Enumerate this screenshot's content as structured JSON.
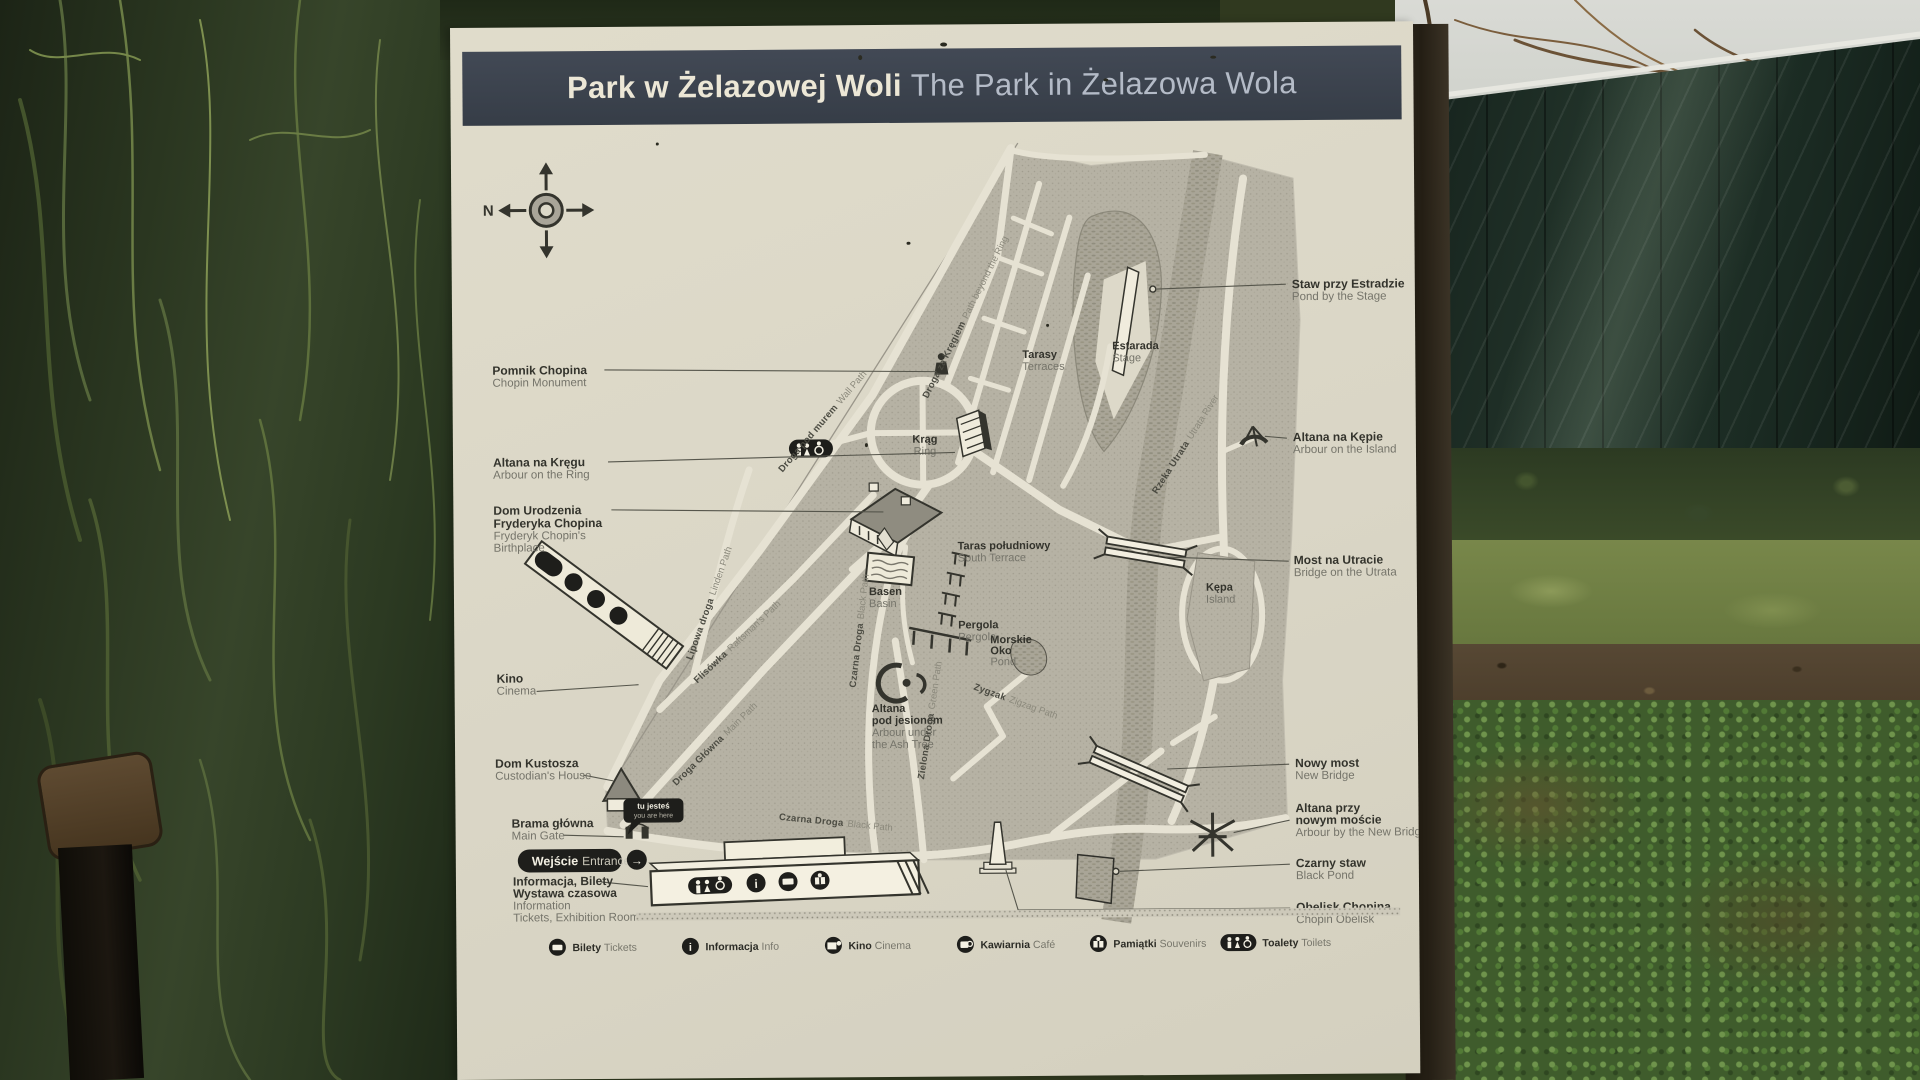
{
  "sign": {
    "title": {
      "pl": "Park w Żelazowej Woli",
      "en": "The Park in Żelazowa Wola"
    },
    "compass": {
      "north": "N"
    },
    "entrance": {
      "pl": "Wejście",
      "en": "Entrance",
      "arrow": "→"
    },
    "you_are_here": {
      "pl": "tu jesteś",
      "en": "you are here"
    },
    "glyphs": {
      "info": "i"
    },
    "callouts_left": [
      {
        "pl": [
          "Pomnik Chopina"
        ],
        "en": [
          "Chopin Monument"
        ]
      },
      {
        "pl": [
          "Altana na Kręgu"
        ],
        "en": [
          "Arbour on the Ring"
        ]
      },
      {
        "pl": [
          "Dom Urodzenia",
          "Fryderyka Chopina"
        ],
        "en": [
          "Fryderyk Chopin's",
          "Birthplace"
        ]
      },
      {
        "pl": [
          "Kino"
        ],
        "en": [
          "Cinema"
        ]
      },
      {
        "pl": [
          "Dom Kustosza"
        ],
        "en": [
          "Custodian's House"
        ]
      },
      {
        "pl": [
          "Brama główna"
        ],
        "en": [
          "Main Gate"
        ]
      },
      {
        "pl": [
          "Informacja, Bilety",
          "Wystawa czasowa"
        ],
        "en": [
          "Information",
          "Tickets, Exhibition Room"
        ]
      }
    ],
    "callouts_right": [
      {
        "pl": [
          "Staw przy Estradzie"
        ],
        "en": [
          "Pond by the Stage"
        ]
      },
      {
        "pl": [
          "Altana na Kępie"
        ],
        "en": [
          "Arbour on the Island"
        ]
      },
      {
        "pl": [
          "Most na Utracie"
        ],
        "en": [
          "Bridge on the Utrata"
        ]
      },
      {
        "pl": [
          "Nowy most"
        ],
        "en": [
          "New Bridge"
        ]
      },
      {
        "pl": [
          "Altana przy",
          "nowym moście"
        ],
        "en": [
          "Arbour by the New Bridge"
        ]
      },
      {
        "pl": [
          "Czarny staw"
        ],
        "en": [
          "Black Pond"
        ]
      },
      {
        "pl": [
          "Obelisk Chopina"
        ],
        "en": [
          "Chopin Obelisk"
        ]
      }
    ],
    "map_labels": [
      {
        "pl": [
          "Estarada"
        ],
        "en": [
          "Stage"
        ]
      },
      {
        "pl": [
          "Tarasy"
        ],
        "en": [
          "Terraces"
        ]
      },
      {
        "pl": [
          "Krąg"
        ],
        "en": [
          "Ring"
        ]
      },
      {
        "pl": [
          "Taras południowy"
        ],
        "en": [
          "South Terrace"
        ]
      },
      {
        "pl": [
          "Basen"
        ],
        "en": [
          "Basin"
        ]
      },
      {
        "pl": [
          "Pergola"
        ],
        "en": [
          "Pergola"
        ]
      },
      {
        "pl": [
          "Morskie",
          "Oko"
        ],
        "en": [
          "Pond"
        ]
      },
      {
        "pl": [
          "Altana",
          "pod jesionem"
        ],
        "en": [
          "Arbour under",
          "the Ash Tree"
        ]
      },
      {
        "pl": [
          "Kępa"
        ],
        "en": [
          "Island"
        ]
      }
    ],
    "path_labels": [
      {
        "pl": "Droga pod murem",
        "en": "Wall Path"
      },
      {
        "pl": "Droga za Kręgiem",
        "en": "Path beyond the Ring"
      },
      {
        "pl": "Lipowa droga",
        "en": "Linden Path"
      },
      {
        "pl": "Flisówka",
        "en": "Raftsman's Path"
      },
      {
        "pl": "Droga Główna",
        "en": "Main Path"
      },
      {
        "pl": "Czarna Droga",
        "en": "Black Path"
      },
      {
        "pl": "Czarna Droga",
        "en": "Black Path"
      },
      {
        "pl": "Zielona Droga",
        "en": "Green Path"
      },
      {
        "pl": "Zygzak",
        "en": "Zigzag Path"
      },
      {
        "pl": "Rzeka Utrata",
        "en": "Utrata River"
      }
    ],
    "legend": [
      {
        "pl": "Bilety",
        "en": "Tickets"
      },
      {
        "pl": "Informacja",
        "en": "Info"
      },
      {
        "pl": "Kino",
        "en": "Cinema"
      },
      {
        "pl": "Kawiarnia",
        "en": "Café"
      },
      {
        "pl": "Pamiątki",
        "en": "Souvenirs"
      },
      {
        "pl": "Toalety",
        "en": "Toilets"
      }
    ],
    "colors": {
      "board": "#dcd8c8",
      "title_bar": "#3a414b",
      "title_pl": "#ece7d6",
      "title_en": "#b4bbc7",
      "ink": "#34342d",
      "map_fill": "#b6b2a4",
      "path_cream": "#e6e2d3",
      "river": "#a9a597",
      "black": "#1e1e1b"
    }
  }
}
